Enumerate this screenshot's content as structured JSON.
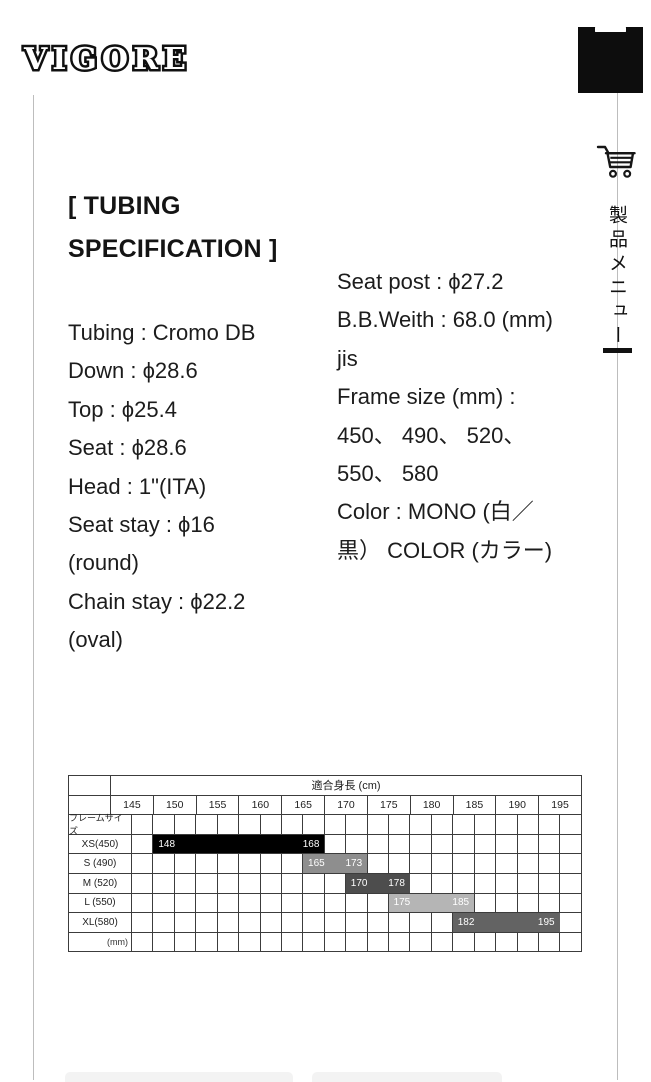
{
  "header": {
    "logo_text": "VIGORE",
    "menu_button_icon": "hamburger-icon"
  },
  "side_rail": {
    "cart_icon": "shopping-cart-icon",
    "menu_label_vertical": "製品メニュー",
    "small_menu_icon": "two-line-menu-icon"
  },
  "main": {
    "heading_lines": [
      "[ TUBING",
      "SPECIFICATION ]"
    ],
    "spec_left_lines": [
      "Tubing : Cromo DB",
      "Down : ϕ28.6",
      "Top : ϕ25.4",
      "Seat : ϕ28.6",
      "Head : 1\"(ITA)",
      "Seat stay : ϕ16",
      "(round)",
      "Chain stay : ϕ22.2",
      "(oval)"
    ],
    "spec_right_lines": [
      "Seat post : ϕ27.2",
      "B.B.Weith : 68.0 (mm)",
      "jis",
      "Frame size (mm) :",
      "450、 490、 520、",
      "550、 580",
      "Color : MONO (白／",
      "黒） COLOR (カラー)"
    ]
  },
  "size_table": {
    "title": "適合身長 (cm)",
    "height_columns": [
      "145",
      "150",
      "155",
      "160",
      "165",
      "170",
      "175",
      "180",
      "185",
      "190",
      "195"
    ],
    "frame_size_label": "フレームサイズ",
    "unit_label": "(mm)",
    "grid_units": 21,
    "rows": [
      {
        "label": "XS(450)",
        "start_label": "148",
        "end_label": "168",
        "bar_color": "#000000",
        "unit_start": 1,
        "unit_end": 9
      },
      {
        "label": "S (490)",
        "start_label": "165",
        "end_label": "173",
        "bar_color": "#8e8e8e",
        "unit_start": 8,
        "unit_end": 11
      },
      {
        "label": "M (520)",
        "start_label": "170",
        "end_label": "178",
        "bar_color": "#4d4d4d",
        "unit_start": 10,
        "unit_end": 13
      },
      {
        "label": "L (550)",
        "start_label": "175",
        "end_label": "185",
        "bar_color": "#b5b5b5",
        "unit_start": 12,
        "unit_end": 16
      },
      {
        "label": "XL(580)",
        "start_label": "182",
        "end_label": "195",
        "bar_color": "#636363",
        "unit_start": 15,
        "unit_end": 20
      }
    ]
  },
  "chart_data": {
    "type": "bar",
    "title": "適合身長 (cm)",
    "x_ticks": [
      145,
      150,
      155,
      160,
      165,
      170,
      175,
      180,
      185,
      190,
      195
    ],
    "xlabel": "適合身長 (cm)",
    "ylabel": "フレームサイズ",
    "series": [
      {
        "name": "XS(450)",
        "range_cm": [
          148,
          168
        ]
      },
      {
        "name": "S (490)",
        "range_cm": [
          165,
          173
        ]
      },
      {
        "name": "M (520)",
        "range_cm": [
          170,
          178
        ]
      },
      {
        "name": "L (550)",
        "range_cm": [
          175,
          185
        ]
      },
      {
        "name": "XL(580)",
        "range_cm": [
          182,
          195
        ]
      }
    ]
  },
  "colors": {
    "menu_square": "#0d0d0d",
    "table_border": "#3c3c3c",
    "page_border_line": "#bdbdbd",
    "footer_button_bg": "#f3f3f3"
  }
}
